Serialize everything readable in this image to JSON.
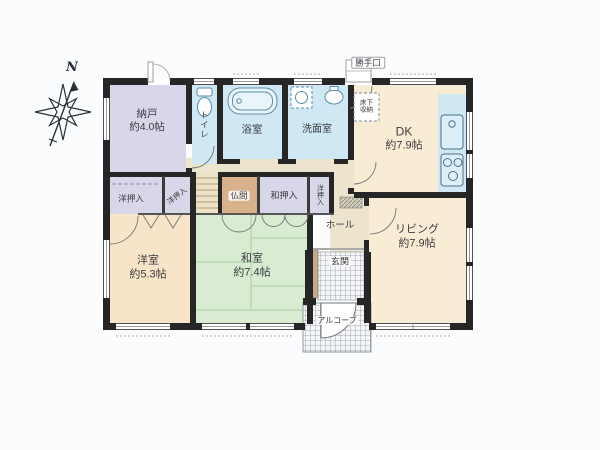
{
  "compass": {
    "north": "N"
  },
  "rooms": {
    "nando": {
      "label": "納戸",
      "size": "約4.0帖"
    },
    "toilet": {
      "label": "トイレ"
    },
    "bathroom": {
      "label": "浴室"
    },
    "washroom": {
      "label": "洗面室"
    },
    "dk": {
      "label": "DK",
      "size": "約7.9帖"
    },
    "living": {
      "label": "リビング",
      "size": "約7.9帖"
    },
    "japanese_room": {
      "label": "和室",
      "size": "約7.4帖"
    },
    "western_room": {
      "label": "洋室",
      "size": "約5.3帖"
    },
    "hall": {
      "label": "ホール"
    },
    "entrance": {
      "label": "玄関"
    },
    "alcove": {
      "label": "アルコーブ"
    },
    "butsuma": {
      "label": "仏間"
    },
    "wa_closet": {
      "label": "和押入"
    },
    "yo_closet_left": {
      "label": "洋押入"
    },
    "yo_closet_mid": {
      "label": "洋押入"
    },
    "yo_closet_right": {
      "label": "洋押入"
    },
    "back_door": {
      "label": "勝手口"
    },
    "underfloor_storage": {
      "label": "床下収納"
    }
  },
  "colors": {
    "wall": "#262626",
    "room_cream": "#f9ecd4",
    "room_blue": "#cfe8f4",
    "room_lavender": "#d8d7e9",
    "room_green": "#d9ebd1",
    "room_peach": "#f8e5c9",
    "room_tan": "#d7b28c",
    "corridor_beige": "#ece4cd",
    "tile_line": "#8b9098"
  }
}
